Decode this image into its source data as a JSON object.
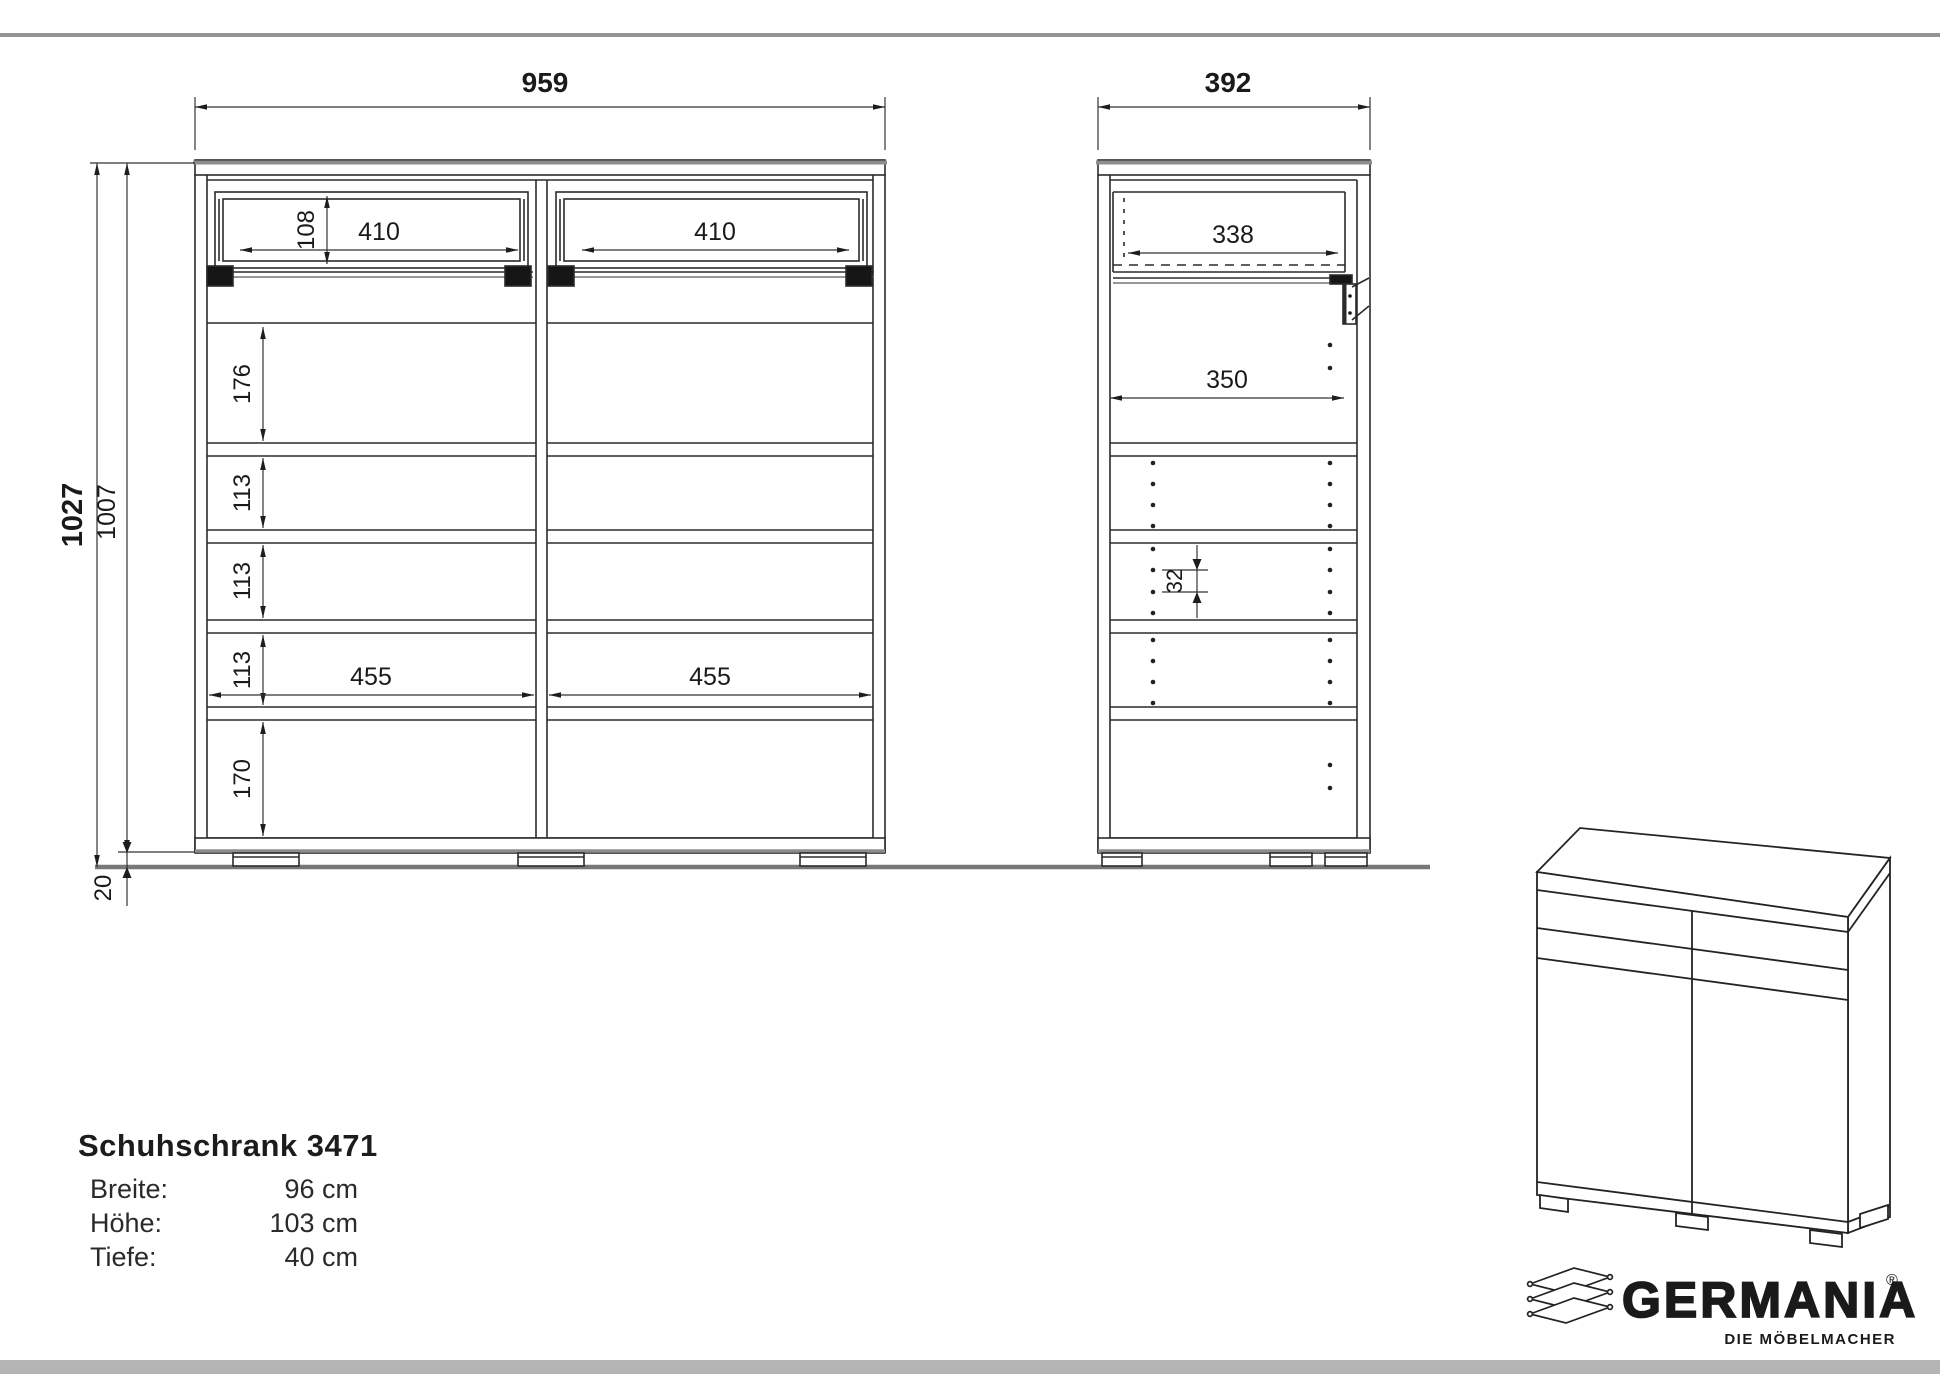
{
  "front_view": {
    "width": "959",
    "height_total": "1027",
    "height_carcass": "1007",
    "drawer_inner_height": "108",
    "drawer_width_left": "410",
    "drawer_width_right": "410",
    "gap_top": "176",
    "gap_1": "113",
    "gap_2": "113",
    "gap_3": "113",
    "gap_bottom": "170",
    "compartment_left": "455",
    "compartment_right": "455",
    "plinth_height": "20"
  },
  "side_view": {
    "depth": "392",
    "drawer_depth": "338",
    "shelf_depth": "350",
    "hole_pitch": "32"
  },
  "title_block": {
    "title": "Schuhschrank 3471",
    "rows": [
      {
        "label": "Breite:",
        "value": "96 cm"
      },
      {
        "label": "Höhe:",
        "value": "103 cm"
      },
      {
        "label": "Tiefe:",
        "value": "40 cm"
      }
    ]
  },
  "brand": {
    "wordmark": "GERMANIA",
    "registered": "®",
    "tagline": "DIE MÖBELMACHER"
  }
}
